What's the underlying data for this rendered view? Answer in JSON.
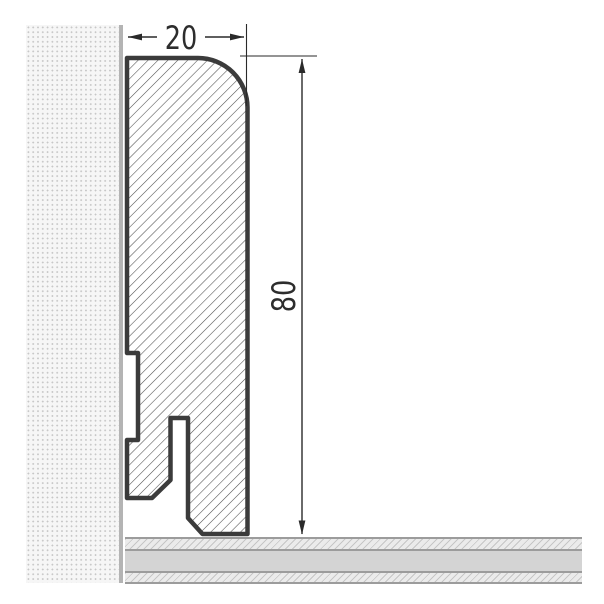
{
  "drawing": {
    "type": "skirting-board-cross-section",
    "width_dim": {
      "label": "20"
    },
    "height_dim": {
      "label": "80"
    },
    "colors": {
      "profile_outline": "#3b3b3b",
      "profile_hatch": "#4d4d4d",
      "dimension": "#2a2a2a",
      "wall_fill": "#f6f6f6",
      "wall_dots": "#c7c7c7",
      "wall_edge": "#b4b4b4",
      "floor_border": "#9c9c9c",
      "floor_solid": "#d4d4d4",
      "floor_hatch_bg": "#ebebeb"
    }
  }
}
